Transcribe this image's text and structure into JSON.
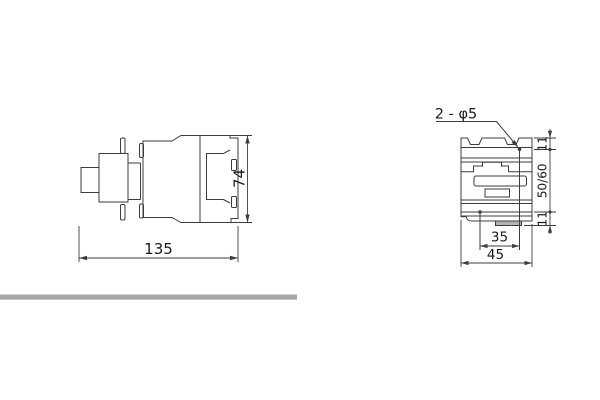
{
  "colors": {
    "line": "#3d3d3d",
    "text": "#1b1b1b",
    "divider": "#a7a7a7",
    "tab_fill": "#b3b3b3"
  },
  "side_view": {
    "label_width": "135",
    "label_height": "74"
  },
  "front_view": {
    "label_holes": "2 - φ5",
    "label_top_offset": "11",
    "label_hole_span_vertical": "50/60",
    "label_bottom_offset": "11",
    "label_hole_span_horizontal": "35",
    "label_width": "45"
  }
}
